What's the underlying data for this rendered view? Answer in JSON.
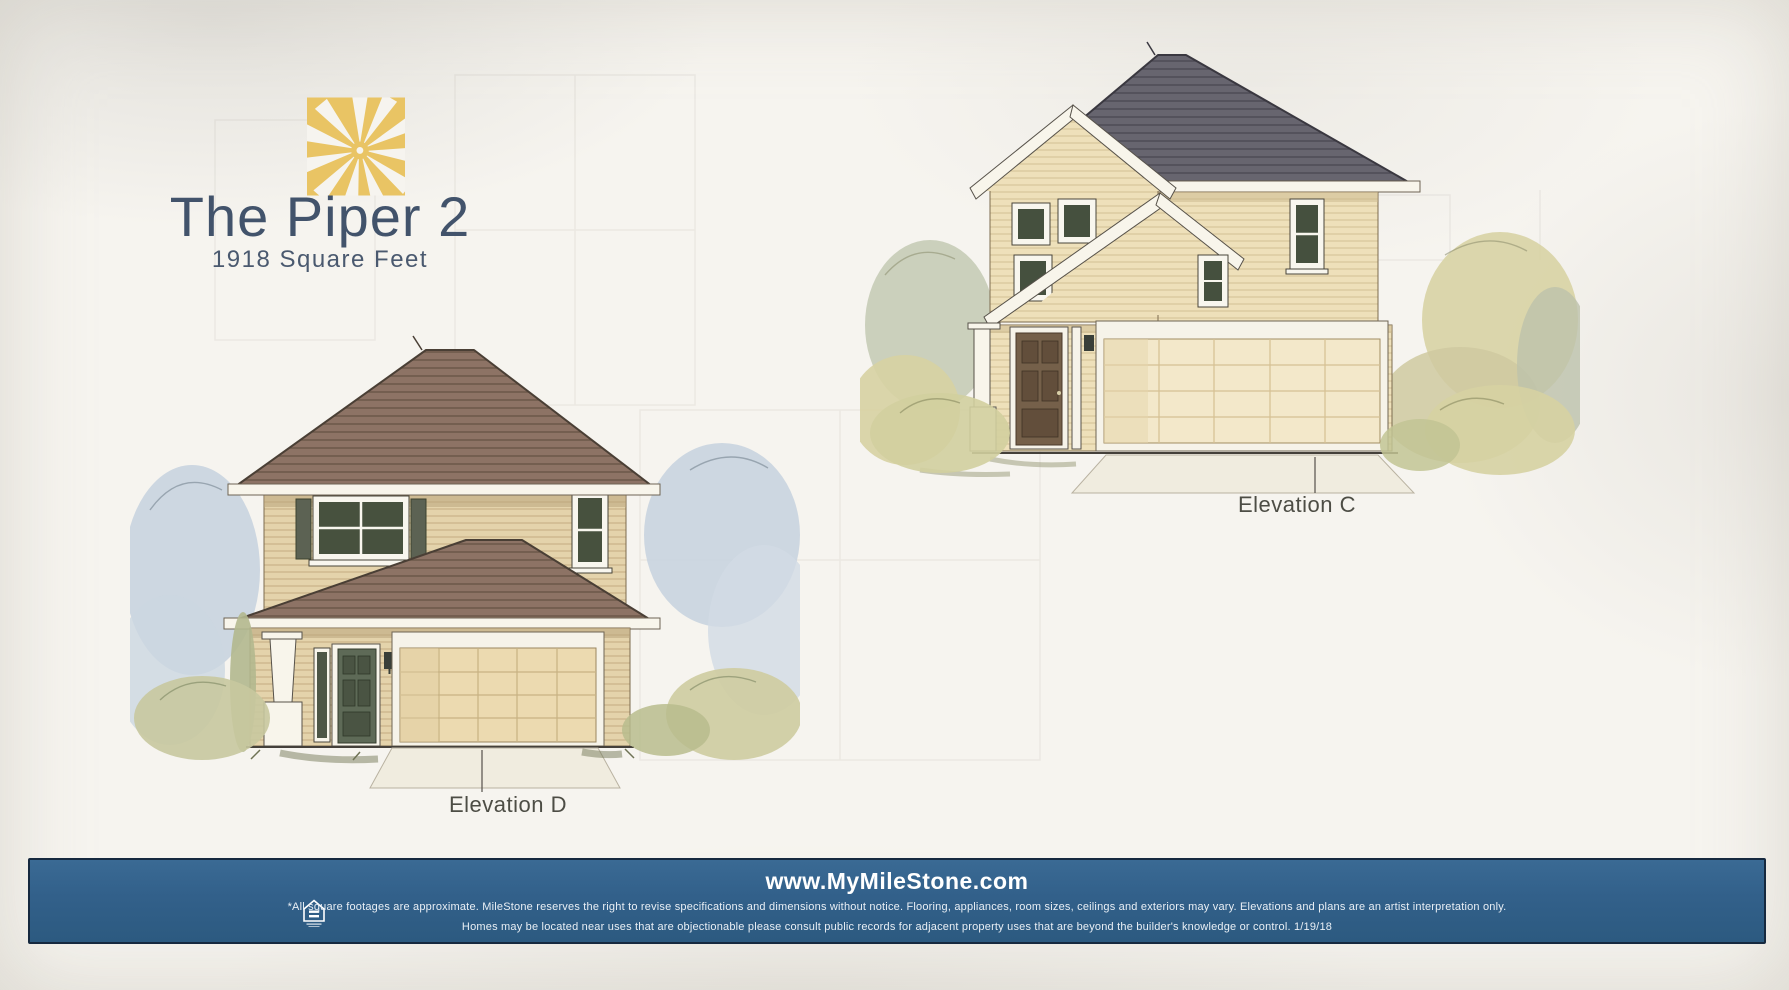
{
  "page": {
    "paper_color": "#f5f3ee",
    "accent_gold": "#e8c566",
    "accent_slate": "#42536b",
    "footer_bar_color": "#32608a"
  },
  "header": {
    "logo": "milestone-sunburst-logo",
    "title": "The Piper 2",
    "subtitle": "1918 Square Feet"
  },
  "elevations": [
    {
      "label": "Elevation D"
    },
    {
      "label": "Elevation C"
    }
  ],
  "footer": {
    "website": "www.MyMileStone.com",
    "icon": "equal-housing-opportunity",
    "disclaimer_line1": "*All square footages are approximate. MileStone reserves the right to revise specifications and dimensions without notice. Flooring, appliances, room sizes, ceilings and exteriors may vary. Elevations and plans are an artist interpretation only.",
    "disclaimer_line2": "Homes may be located near uses that are objectionable please consult public records for adjacent property uses that are beyond the builder's knowledge or control.  1/19/18"
  }
}
